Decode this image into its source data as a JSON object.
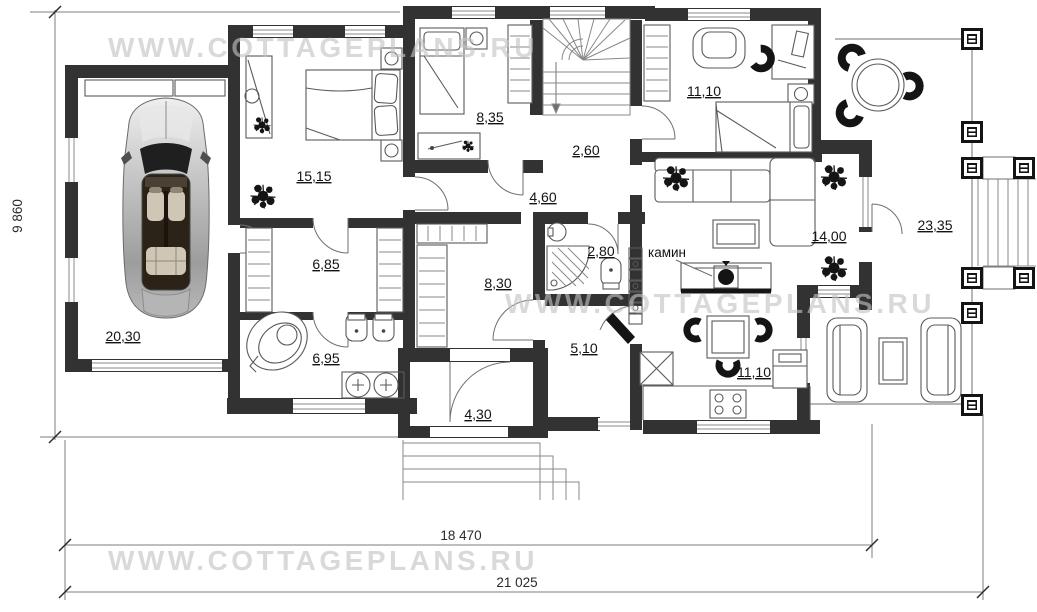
{
  "watermark": {
    "text": "WWW.COTTAGEPLANS.RU",
    "color": "#c3c3c3"
  },
  "rooms": [
    {
      "name": "garage",
      "area": "20,30"
    },
    {
      "name": "master-bedroom",
      "area": "15,15"
    },
    {
      "name": "bedroom",
      "area": "8,35"
    },
    {
      "name": "stair-hall",
      "area": "2,60"
    },
    {
      "name": "corridor",
      "area": "4,60"
    },
    {
      "name": "office-bedroom",
      "area": "11,10"
    },
    {
      "name": "wardrobe",
      "area": "6,85"
    },
    {
      "name": "hallway",
      "area": "8,30"
    },
    {
      "name": "shower-room",
      "area": "2,80"
    },
    {
      "name": "bathroom",
      "area": "6,95"
    },
    {
      "name": "hall",
      "area": "5,10"
    },
    {
      "name": "vestibule",
      "area": "4,30"
    },
    {
      "name": "living-room",
      "area": "14,00"
    },
    {
      "name": "kitchen-dining",
      "area": "11,10"
    },
    {
      "name": "terrace",
      "area": "23,35"
    }
  ],
  "annotations": {
    "fireplace": "камин"
  },
  "dimensions": {
    "side": "9 860",
    "bottom_inner": "18 470",
    "bottom_outer": "21 025"
  },
  "colors": {
    "wall": "#323232",
    "furniture_line": "#5a5a5a"
  }
}
